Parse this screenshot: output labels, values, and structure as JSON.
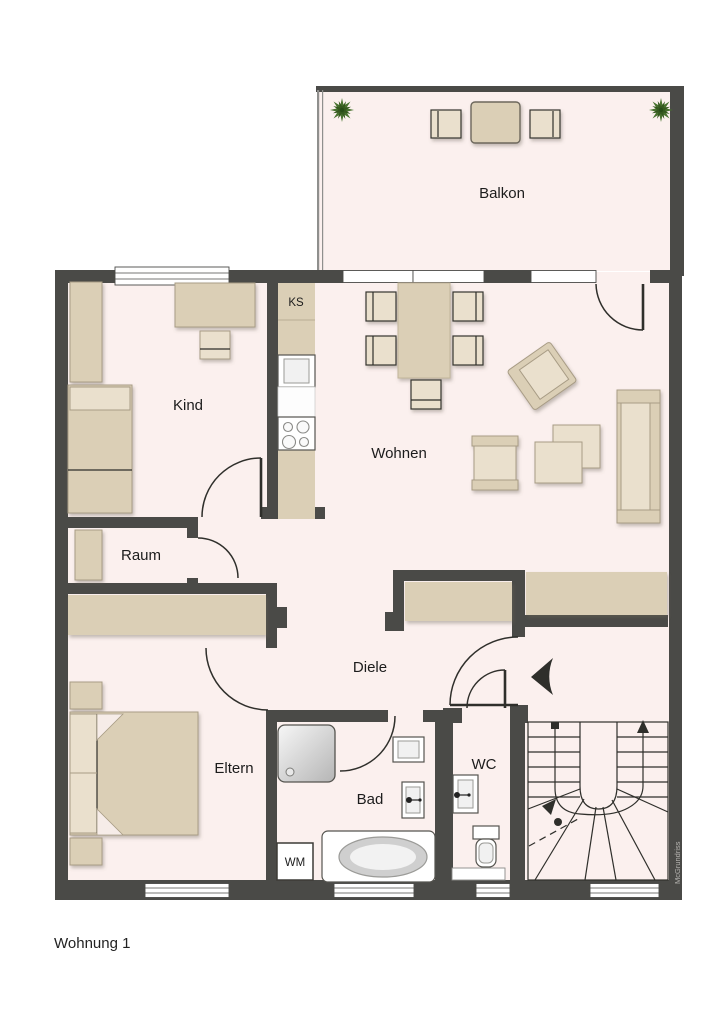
{
  "page_title": "Wohnung 1",
  "watermark": "McGrundriss",
  "rooms": {
    "balkon": "Balkon",
    "kind": "Kind",
    "wohnen": "Wohnen",
    "raum": "Raum",
    "diele": "Diele",
    "eltern": "Eltern",
    "bad": "Bad",
    "wc": "WC"
  },
  "labels": {
    "ks": "KS",
    "wm": "WM"
  },
  "colors": {
    "wall": "#4a4a47",
    "floor": "#fbf0ee",
    "furniture": "#dbcfb6",
    "furniture_light": "#eae0cd",
    "plant_green": "#47722e",
    "plant_dark": "#35591f",
    "text": "#1c1c1c",
    "watermark_gray": "#b8b6b2"
  }
}
